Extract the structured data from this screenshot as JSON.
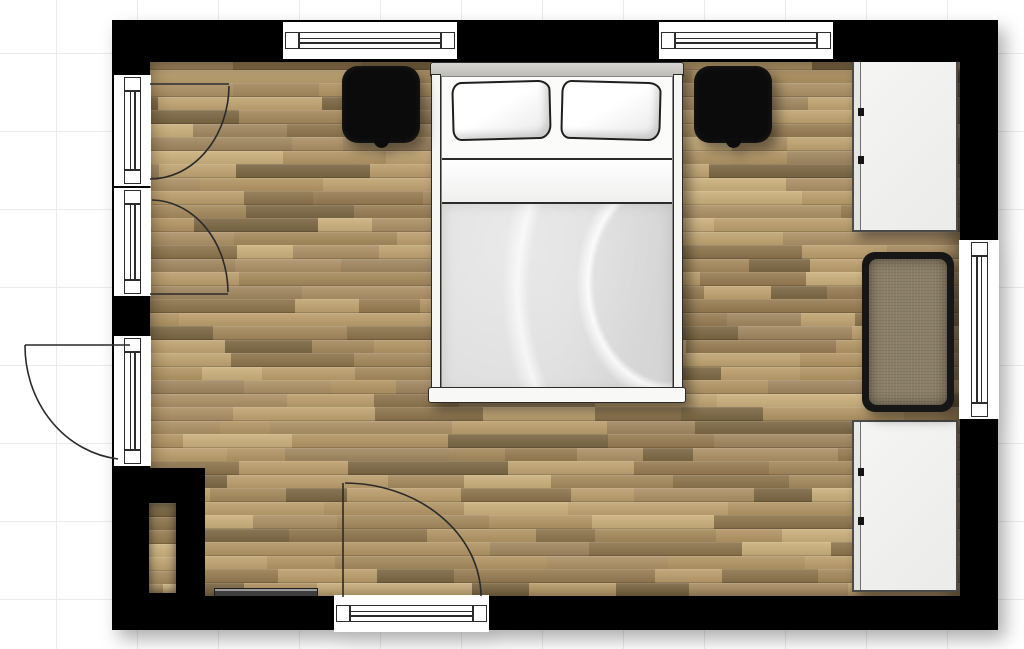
{
  "meta": {
    "application": "floor-plan-viewer",
    "view": "2d-top-down",
    "room": "bedroom"
  },
  "canvas": {
    "width": 1024,
    "height": 649,
    "background": "#ffffff",
    "grid": {
      "step_x": 81,
      "step_y": 78,
      "offset_x": -24,
      "offset_y": -24,
      "line_color": "#ebebeb"
    }
  },
  "building": {
    "outline": {
      "x": 112,
      "y": 20,
      "w": 886,
      "h": 612
    },
    "wall_color": "#000000",
    "drop_shadow": "drop-shadow(7px 9px 9px rgba(0,0,0,0.32))"
  },
  "floor": {
    "x": 148,
    "y": 56,
    "w": 814,
    "h": 544,
    "plank_height": 13.5,
    "seed": 11,
    "palette": [
      "#b29564",
      "#a5895c",
      "#c0a471",
      "#977c52",
      "#ad9166",
      "#8d744c",
      "#bb9e6c",
      "#a18760",
      "#cbb07c",
      "#7c6743"
    ],
    "gap_color": "rgba(58,42,22,0.5)",
    "shade": "inset 0 16px 22px -8px rgba(40,28,12,0.55), inset -16px 0 22px -8px rgba(40,28,12,0.45), inset 14px 0 20px -12px rgba(40,28,12,0.33), inset 0 -12px 18px -10px rgba(40,28,12,0.33)"
  },
  "walls": [
    {
      "id": "wall-top",
      "x": 112,
      "y": 20,
      "w": 886,
      "h": 42
    },
    {
      "id": "wall-bottom",
      "x": 112,
      "y": 596,
      "w": 886,
      "h": 34
    },
    {
      "id": "wall-left",
      "x": 112,
      "y": 20,
      "w": 38,
      "h": 610
    },
    {
      "id": "wall-right",
      "x": 960,
      "y": 20,
      "w": 38,
      "h": 610
    },
    {
      "id": "wall-chimney-block",
      "x": 112,
      "y": 468,
      "w": 93,
      "h": 162
    }
  ],
  "niche": {
    "x": 149,
    "y": 503,
    "w": 27,
    "h": 90
  },
  "windows": [
    {
      "id": "window-top-left",
      "orient": "h",
      "x": 283,
      "y": 22,
      "w": 174,
      "h": 37
    },
    {
      "id": "window-top-right",
      "orient": "h",
      "x": 659,
      "y": 22,
      "w": 174,
      "h": 37
    },
    {
      "id": "window-left-upper",
      "orient": "v",
      "x": 114,
      "y": 75,
      "w": 37,
      "h": 111
    },
    {
      "id": "window-left-lower",
      "orient": "v",
      "x": 114,
      "y": 188,
      "w": 37,
      "h": 108
    },
    {
      "id": "door-left-glass",
      "orient": "v",
      "x": 114,
      "y": 336,
      "w": 37,
      "h": 130
    },
    {
      "id": "window-right",
      "orient": "v",
      "x": 959,
      "y": 240,
      "w": 40,
      "h": 179
    },
    {
      "id": "door-bottom-glass",
      "orient": "h",
      "x": 334,
      "y": 595,
      "w": 155,
      "h": 37
    }
  ],
  "door_swings": [
    {
      "id": "door-swing-left-upper",
      "leaf": [
        150,
        84,
        229,
        84
      ],
      "arc": {
        "fx": 229,
        "fy": 86,
        "rx": 79,
        "ry": 94,
        "sweep": 1,
        "tx": 150,
        "ty": 179
      }
    },
    {
      "id": "door-swing-left-lower",
      "leaf": [
        150,
        294,
        228,
        294
      ],
      "arc": {
        "fx": 152,
        "fy": 200,
        "rx": 77,
        "ry": 93,
        "sweep": 1,
        "tx": 228,
        "ty": 292
      }
    },
    {
      "id": "door-swing-left-out",
      "leaf": [
        130,
        345,
        25,
        345
      ],
      "arc": {
        "fx": 25,
        "fy": 345,
        "rx": 105,
        "ry": 114,
        "sweep": 0,
        "tx": 118,
        "ty": 459
      }
    },
    {
      "id": "door-swing-bottom",
      "leaf": [
        343,
        597,
        343,
        483
      ],
      "arc": {
        "fx": 345,
        "fy": 483,
        "rx": 137,
        "ry": 114,
        "sweep": 1,
        "tx": 481,
        "ty": 596
      }
    }
  ],
  "furniture": [
    {
      "id": "double-bed",
      "kind": "bed",
      "x": 428,
      "y": 62,
      "w": 258,
      "h": 341,
      "colors": {
        "outline": "#2b2b2b",
        "headboard_light": "#d7d6d1",
        "headboard_dark": "#bbbab4",
        "rail": "#f6f6f4",
        "sheet": "#fbfbfa",
        "fold_light": "#ffffff",
        "fold_dark": "#efefee",
        "duvet_a": "#dedede",
        "duvet_b": "#d3d3d3",
        "footboard": "#f8f8f6"
      },
      "pillows": [
        {
          "x": 24,
          "y": 19,
          "w": 99,
          "h": 59,
          "rot": -1.5
        },
        {
          "x": 133,
          "y": 19,
          "w": 100,
          "h": 59,
          "rot": 1.5
        }
      ]
    },
    {
      "id": "nightstand-left",
      "kind": "nightstand",
      "x": 342,
      "y": 66,
      "w": 78,
      "h": 77,
      "color": "#0b0b0b"
    },
    {
      "id": "nightstand-right",
      "kind": "nightstand",
      "x": 694,
      "y": 66,
      "w": 78,
      "h": 77,
      "color": "#0b0b0b"
    },
    {
      "id": "wardrobe-top-right",
      "kind": "wardrobe",
      "x": 852,
      "y": 60,
      "w": 106,
      "h": 172,
      "fill_a": "#f5f5f4",
      "fill_b": "#ebebea",
      "border": "#4a4a4a",
      "handle_color": "#141414",
      "handles_y": [
        46,
        94
      ]
    },
    {
      "id": "wardrobe-bottom-right",
      "kind": "wardrobe",
      "x": 852,
      "y": 420,
      "w": 106,
      "h": 172,
      "fill_a": "#f5f5f4",
      "fill_b": "#ebebea",
      "border": "#4a4a4a",
      "handle_color": "#141414",
      "handles_y": [
        46,
        95
      ]
    },
    {
      "id": "ottoman-bench",
      "kind": "ottoman",
      "x": 862,
      "y": 252,
      "w": 92,
      "h": 160,
      "frame": "#161616",
      "fabric": "#8a7e66"
    },
    {
      "id": "wall-shelf",
      "kind": "shelf",
      "x": 214,
      "y": 588,
      "w": 104,
      "h": 9,
      "top": "#9b9b9b",
      "body": "#3e3e3e",
      "border": "#1d1d1d"
    }
  ],
  "stroke": {
    "glyph": "#2d2d2d",
    "arc": "#2a2a2a",
    "furniture_shadow": "drop-shadow(6px 7px 6px rgba(0,0,0,0.42))"
  }
}
